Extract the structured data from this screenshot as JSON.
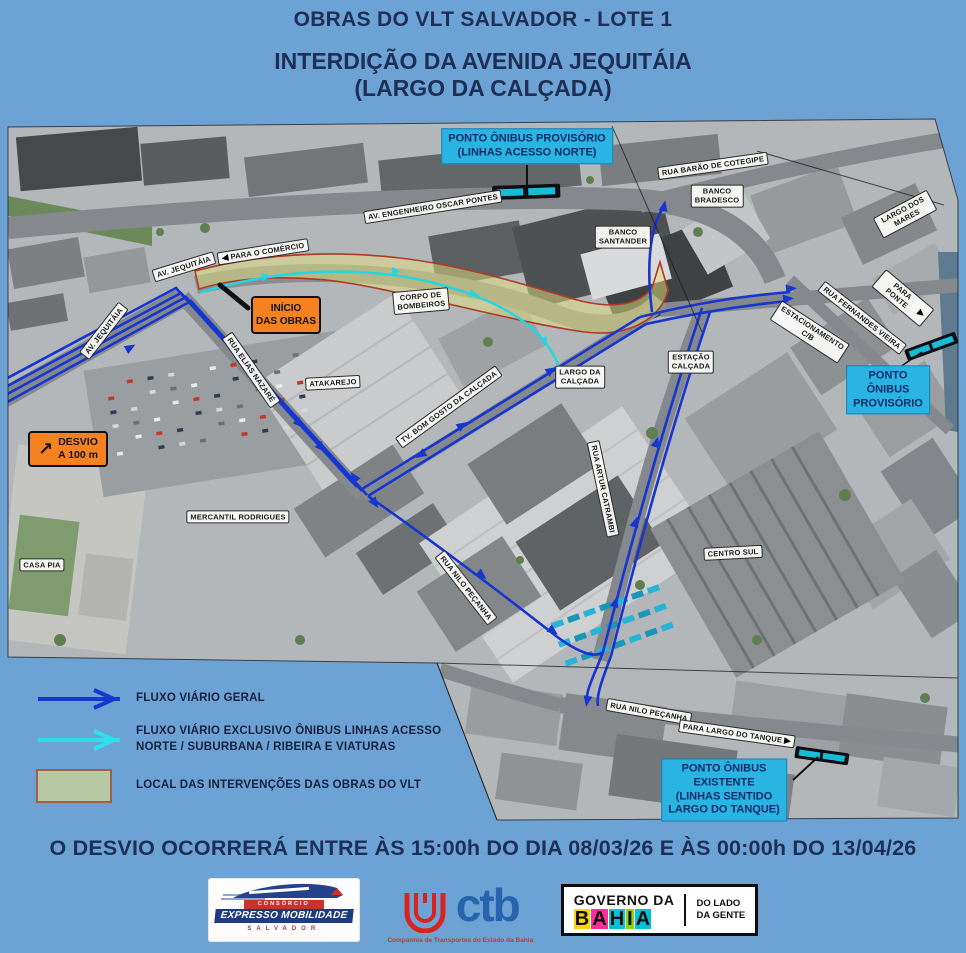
{
  "header": {
    "title_line1": "OBRAS DO VLT SALVADOR - LOTE 1",
    "title_line2": "INTERDIÇÃO DA AVENIDA JEQUITÁIA",
    "title_line3": "(LARGO DA CALÇADA)"
  },
  "map": {
    "signs": {
      "inicio": {
        "line1": "INÍCIO",
        "line2": "DAS OBRAS"
      },
      "desvio": {
        "arrow": "↗",
        "line1": "DESVIO",
        "line2": "A 100 m"
      }
    },
    "labels": [
      {
        "text": "PARA O COMÉRCIO",
        "x": 263,
        "y": 252,
        "rot": -9,
        "kind": "w",
        "arrow": "left"
      },
      {
        "text": "AV. ENGENHEIRO OSCAR PONTES",
        "x": 433,
        "y": 207,
        "rot": -9,
        "kind": "w"
      },
      {
        "text": "AV. JEQUITÁIA",
        "x": 184,
        "y": 267,
        "rot": -17,
        "kind": "w"
      },
      {
        "text": "AV. JEQUITÁIA",
        "x": 104,
        "y": 331,
        "rot": -52,
        "kind": "w"
      },
      {
        "text": "CORPO DE\nBOMBEIROS",
        "x": 421,
        "y": 301,
        "rot": -5,
        "kind": "w"
      },
      {
        "text": "ATAKAREJO",
        "x": 333,
        "y": 383,
        "rot": -3,
        "kind": "w"
      },
      {
        "text": "BANCO\nSANTANDER",
        "x": 623,
        "y": 237,
        "rot": 0,
        "kind": "w"
      },
      {
        "text": "BANCO\nBRADESCO",
        "x": 717,
        "y": 196,
        "rot": 0,
        "kind": "w"
      },
      {
        "text": "RUA BARÃO DE COTEGIPE",
        "x": 713,
        "y": 166,
        "rot": -8,
        "kind": "w"
      },
      {
        "text": "LARGO DOS MARES",
        "x": 905,
        "y": 214,
        "rot": -28,
        "kind": "w"
      },
      {
        "text": "PARA PONTE",
        "x": 903,
        "y": 298,
        "rot": 40,
        "kind": "w",
        "arrow": "right"
      },
      {
        "text": "RUA FERNANDES VIEIRA",
        "x": 862,
        "y": 318,
        "rot": 38,
        "kind": "w"
      },
      {
        "text": "ESTACIONAMENTO\nC/B",
        "x": 810,
        "y": 332,
        "rot": 33,
        "kind": "w"
      },
      {
        "text": "ESTAÇÃO\nCALÇADA",
        "x": 691,
        "y": 362,
        "rot": 0,
        "kind": "w"
      },
      {
        "text": "LARGO DA\nCALÇADA",
        "x": 580,
        "y": 377,
        "rot": 0,
        "kind": "w"
      },
      {
        "text": "TV. BOM GOSTO DA CALÇADA",
        "x": 449,
        "y": 407,
        "rot": -36,
        "kind": "w"
      },
      {
        "text": "RUA ARTUR CATRAMBI",
        "x": 603,
        "y": 489,
        "rot": 78,
        "kind": "w"
      },
      {
        "text": "RUA ELIAS NAZARÉ",
        "x": 251,
        "y": 370,
        "rot": 55,
        "kind": "w"
      },
      {
        "text": "RUA NILO PEÇANHA",
        "x": 466,
        "y": 588,
        "rot": 52,
        "kind": "w"
      },
      {
        "text": "MERCANTIL RODRIGUES",
        "x": 238,
        "y": 517,
        "rot": 0,
        "kind": "w"
      },
      {
        "text": "CASA PIA",
        "x": 42,
        "y": 565,
        "rot": 0,
        "kind": "w"
      },
      {
        "text": "CENTRO SUL",
        "x": 733,
        "y": 553,
        "rot": -3,
        "kind": "w"
      },
      {
        "text": "RUA NILO PEÇANHA",
        "x": 649,
        "y": 712,
        "rot": 10,
        "kind": "w"
      },
      {
        "text": "PARA LARGO DO TANQUE",
        "x": 737,
        "y": 734,
        "rot": 8,
        "kind": "w",
        "arrow": "right"
      },
      {
        "text": "PONTO ÔNIBUS PROVISÓRIO\n(LINHAS ACESSO NORTE)",
        "x": 527,
        "y": 146,
        "rot": 0,
        "kind": "c"
      },
      {
        "text": "PONTO ÔNIBUS\nPROVISÓRIO",
        "x": 888,
        "y": 390,
        "rot": 0,
        "kind": "c"
      },
      {
        "text": "PONTO ÔNIBUS\nEXISTENTE\n(LINHAS SENTIDO\nLARGO DO TANQUE)",
        "x": 724,
        "y": 790,
        "rot": 0,
        "kind": "c"
      }
    ]
  },
  "legend": {
    "items": [
      {
        "glyph": "blue-arrow",
        "label": "FLUXO VIÁRIO GERAL"
      },
      {
        "glyph": "cyan-arrow",
        "label": "FLUXO VIÁRIO EXCLUSIVO ÔNIBUS LINHAS ACESSO NORTE / SUBURBANA / RIBEIRA E VIATURAS"
      },
      {
        "glyph": "green-box",
        "label": "LOCAL DAS INTERVENÇÕES DAS OBRAS DO VLT"
      }
    ]
  },
  "banner": {
    "text": "O DESVIO OCORRERÁ ENTRE ÀS 15:00h DO DIA 08/03/26 E ÀS 00:00h DO 13/04/26"
  },
  "logos": {
    "expresso": {
      "top": "CONSÓRCIO",
      "main": "EXPRESSO MOBILIDADE",
      "bottom": "SALVADOR"
    },
    "ctb": {
      "name": "ctb",
      "caption": "Companhia de Transportes do Estado da Bahia"
    },
    "governo": {
      "line1": "GOVERNO DA",
      "line2": "BAHIA",
      "right1": "DO LADO",
      "right2": "DA GENTE"
    }
  },
  "colors": {
    "background": "#6da3d4",
    "title_text": "#1d2f55",
    "flow_blue": "#1636cf",
    "flow_cyan": "#22d6e3",
    "zone_fill": "#e4e07b",
    "zone_border": "#b03a25",
    "bus_label_bg": "#29b4e4",
    "sign_orange": "#f58220"
  }
}
